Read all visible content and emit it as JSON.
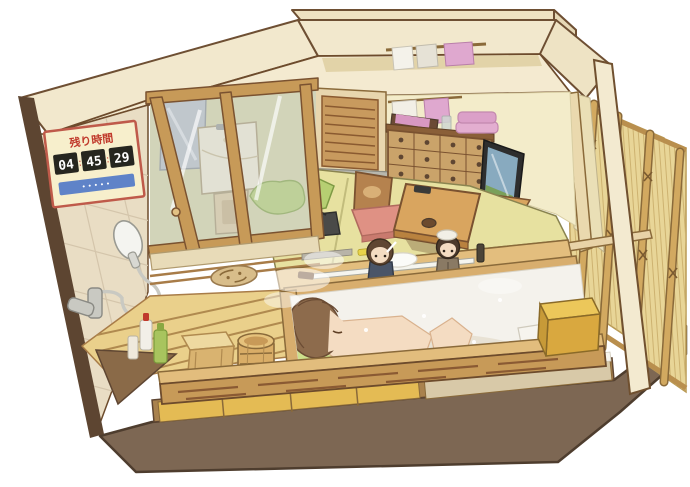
{
  "illustration": {
    "kind": "cutaway-japanese-bathhouse-room",
    "sign": {
      "title": "残り時間",
      "hours": "04",
      "minutes": "45",
      "seconds": "29",
      "separator": ":",
      "footer_note": "•••••"
    },
    "colors": {
      "background": "#ffffff",
      "outline": "#6d4b2c",
      "base_brown": "#7d6753",
      "wall_cream": "#f2e8cd",
      "tile_wall": "#e9ddc4",
      "upper_band": "#f4ead0",
      "back_wall": "#f3ecca",
      "tatami": "#e7e1a0",
      "wood_light": "#e2bd7d",
      "wood_mid": "#c79a58",
      "wood_dark": "#8a5a33",
      "water_milky": "#f4f2ec",
      "bamboo_mat": "#e8d597",
      "bamboo_pole": "#d2a960",
      "glass_tint": "rgba(205,215,220,0.38)",
      "sign_bg": "#f7efcc",
      "sign_red": "#c0392b",
      "sign_blue": "#5f83c8",
      "digit_bg": "#26261f",
      "digit_text": "#ffffff",
      "towel_pink": "#dfa8cf",
      "towel_white": "#f4f2ea",
      "blanket_green": "#b6cf72",
      "cushion_red": "#df9184",
      "hair_brown": "#8d6b4c",
      "skin": "#f4dcc2",
      "tv_screen": "#88aabf",
      "genkan_grey": "#b8b7ad",
      "sunoko_floor": "#ead08b",
      "olive_wall": "#d6d2a4"
    }
  }
}
